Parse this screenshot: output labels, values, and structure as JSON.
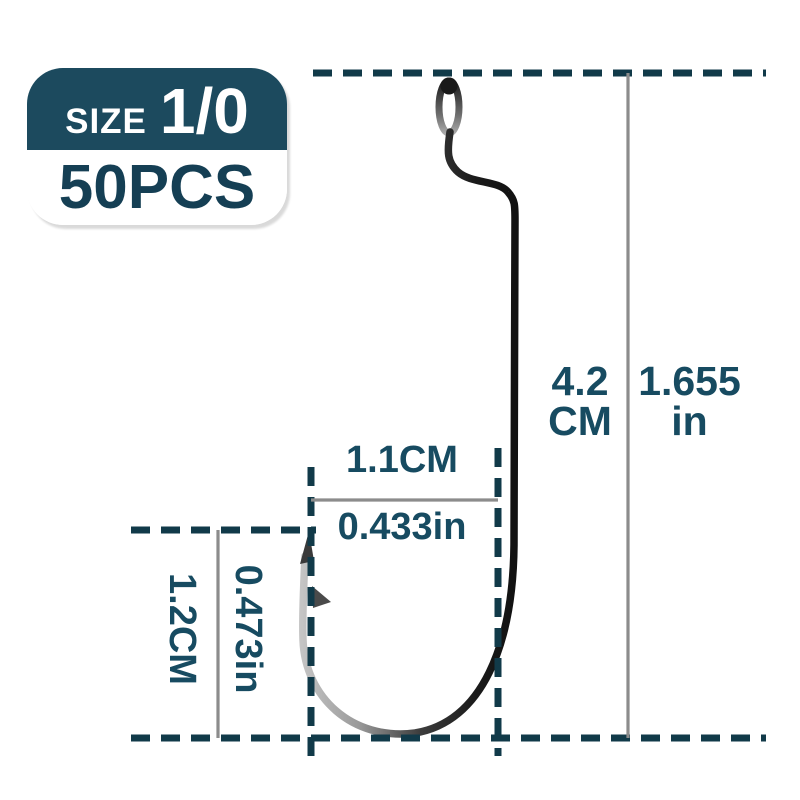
{
  "product_badge": {
    "size_label": "SIZE",
    "size_value": "1/0",
    "quantity": "50PCS"
  },
  "dimensions": {
    "total_length": {
      "cm_value": "4.2",
      "cm_unit": "CM",
      "in_value": "1.655",
      "in_unit": "in"
    },
    "gape_width": {
      "cm": "1.1CM",
      "inches": "0.433in"
    },
    "throat_depth": {
      "cm": "1.2CM",
      "inches": "0.473in"
    }
  },
  "illustration": {
    "subject": "offset worm fishing hook"
  },
  "colors": {
    "teal_text": "#174b61",
    "dash_line": "#113a49",
    "gray_line": "#8c8c8c",
    "badge_bg": "#1c4a5e",
    "badge_text": "#153f54"
  }
}
